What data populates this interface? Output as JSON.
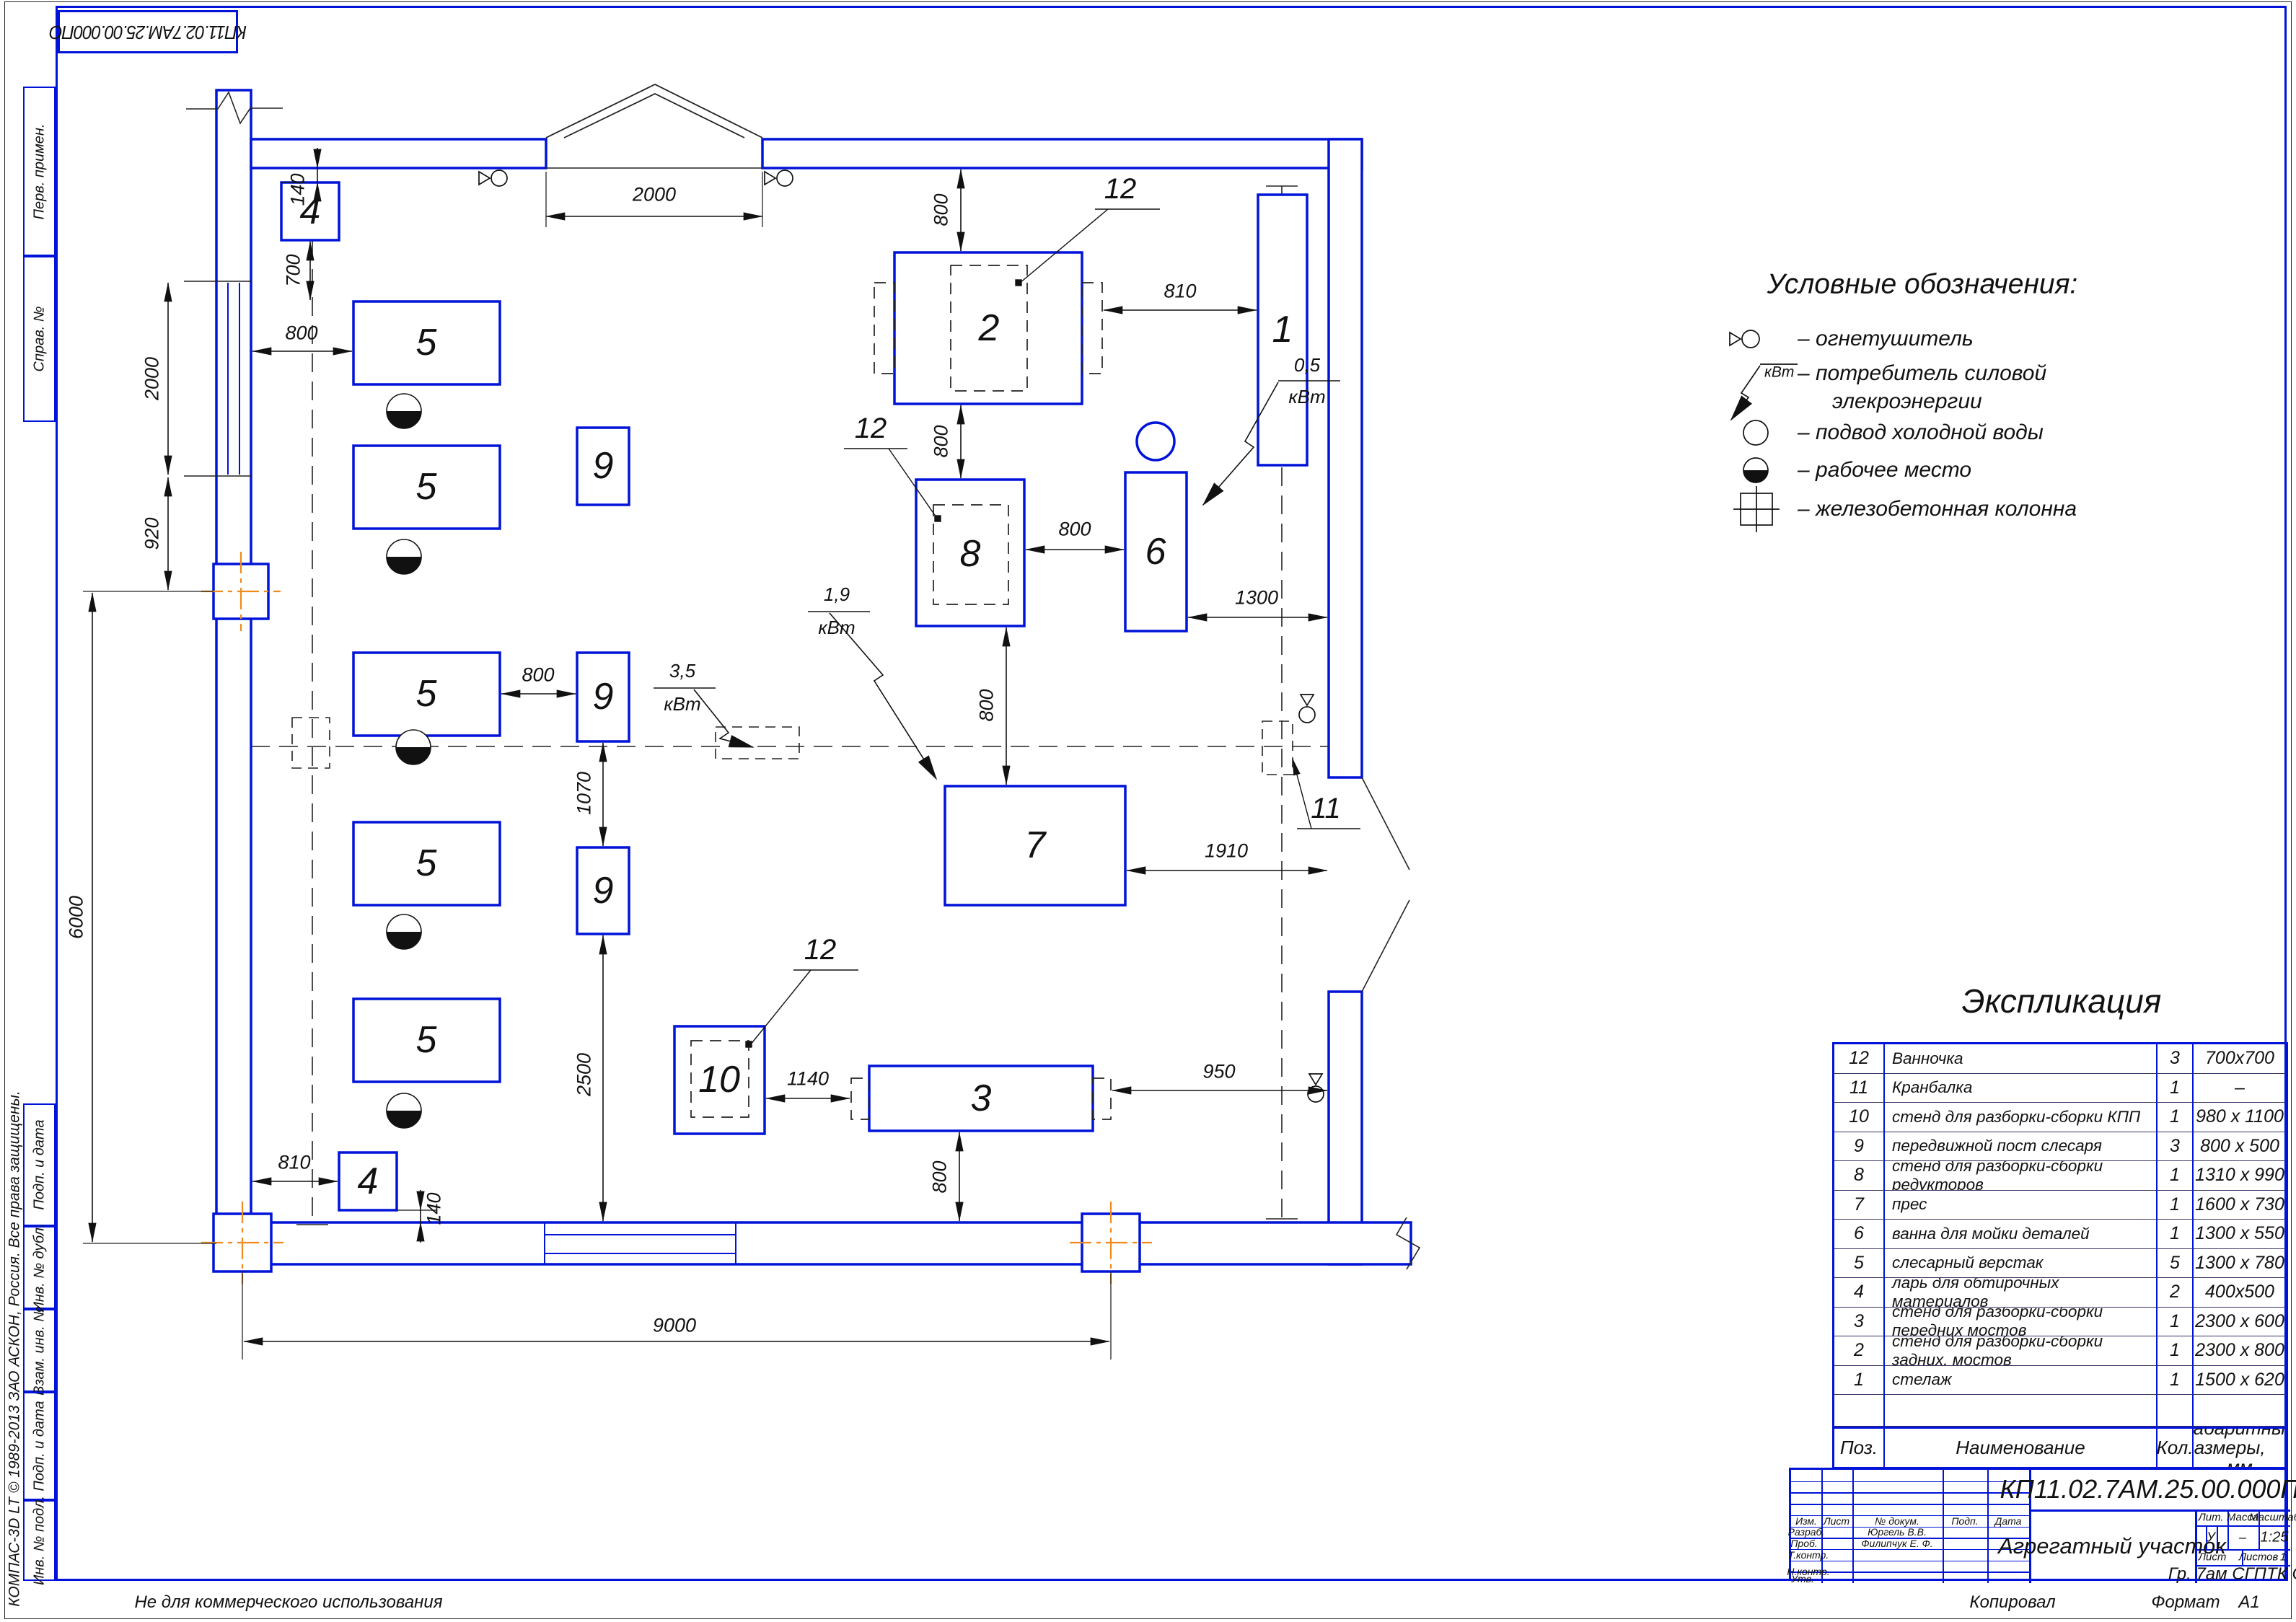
{
  "sheet": {
    "doc_number": "КП11.02.7АМ.25.00.000ПО",
    "kompas_note": "КОМПАС-3D LT © 1989-2013 ЗАО АСКОН, Россия. Все права защищены.",
    "not_commercial": "Не для коммерческого использования",
    "kopiroval": "Копировал",
    "format_label": "Формат",
    "format_value": "А1",
    "margin_labels": [
      "Перв. примен.",
      "Справ. №",
      "Подп. и дата",
      "Инв. № дубл.",
      "Взам. инв. №",
      "Подп. и дата",
      "Инв. № подл."
    ]
  },
  "legend": {
    "title": "Условные обозначения:",
    "items": [
      {
        "icon": "fire-extinguisher-icon",
        "text": "– огнетушитель"
      },
      {
        "icon": "power-consumer-icon",
        "text": "– потребитель силовой",
        "text2": "элекроэнергии",
        "kwt": "кВт"
      },
      {
        "icon": "cold-water-icon",
        "text": "– подвод холодной воды"
      },
      {
        "icon": "workplace-icon",
        "text": "– рабочее место"
      },
      {
        "icon": "concrete-column-icon",
        "text": "– железобетонная колонна"
      }
    ]
  },
  "expl": {
    "title": "Экспликация",
    "header": {
      "pos": "Поз.",
      "name": "Наименование",
      "qty": "Кол.",
      "size": "Габаритные размеры,",
      "size2": "мм"
    },
    "rows": [
      {
        "pos": "12",
        "name": "Ванночка",
        "qty": "3",
        "size": "700х700"
      },
      {
        "pos": "11",
        "name": "Кранбалка",
        "qty": "1",
        "size": "–"
      },
      {
        "pos": "10",
        "name": "стенд для разборки-сборки КПП",
        "qty": "1",
        "size": "980 х 1100"
      },
      {
        "pos": "9",
        "name": "передвижной пост слесаря",
        "qty": "3",
        "size": "800 х 500"
      },
      {
        "pos": "8",
        "name": "стенд для разборки-сборки редукторов",
        "qty": "1",
        "size": "1310 х 990"
      },
      {
        "pos": "7",
        "name": "прес",
        "qty": "1",
        "size": "1600 х 730"
      },
      {
        "pos": "6",
        "name": "ванна для мойки деталей",
        "qty": "1",
        "size": "1300 х 550"
      },
      {
        "pos": "5",
        "name": "слесарный верстак",
        "qty": "5",
        "size": "1300 х 780"
      },
      {
        "pos": "4",
        "name": "ларь для обтирочных материалов",
        "qty": "2",
        "size": "400х500"
      },
      {
        "pos": "3",
        "name": "стенд для разборки-сборки передних мостов",
        "qty": "1",
        "size": "2300 х 600"
      },
      {
        "pos": "2",
        "name": "стенд для разборки-сборки задних. мостов",
        "qty": "1",
        "size": "2300 х 800"
      },
      {
        "pos": "1",
        "name": "стелаж",
        "qty": "1",
        "size": "1500 х 620"
      }
    ]
  },
  "titleblock": {
    "doc_number": "КП11.02.7АМ.25.00.000ПО",
    "title": "Агрегатный участок",
    "group": "Гр. 7ам СГПТК СП",
    "cols": {
      "izm": "Изм.",
      "list": "Лист",
      "doc": "№ докум.",
      "podp": "Подп.",
      "data": "Дата"
    },
    "rows": {
      "razrab": "Разраб.",
      "prov": "Проб.",
      "tkontr": "Т.контр.",
      "nkontr": "Н.контр.",
      "utv": "Утв."
    },
    "names": {
      "razrab": "Юргель В.В.",
      "prov": "Филипчук Е. Ф."
    },
    "lit_label": "Лит.",
    "massa_label": "Масса",
    "masshtab_label": "Масштаб",
    "lit": "У",
    "massa": "–",
    "masshtab": "1:25",
    "list_label": "Лист",
    "listov_label": "Листов",
    "listov": "1"
  },
  "plan": {
    "labels": {
      "b1": "1",
      "b2": "2",
      "b3": "3",
      "b4": "4",
      "b5": "5",
      "b6": "6",
      "b7": "7",
      "b8": "8",
      "b9": "9",
      "b10": "10",
      "c11": "11",
      "c12": "12"
    },
    "dims": {
      "gate": "2000",
      "window": "2000",
      "pier": "920",
      "wall_left": "6000",
      "wall_bottom": "9000",
      "d700": "700",
      "d140": "140",
      "d810": "810",
      "d800": "800",
      "d1070": "1070",
      "d2500": "2500",
      "d1140": "1140",
      "d1300": "1300",
      "d1910": "1910",
      "d950": "950"
    },
    "power": {
      "v05": "0,5",
      "v19": "1,9",
      "v35": "3,5",
      "kwt": "кВт"
    }
  }
}
